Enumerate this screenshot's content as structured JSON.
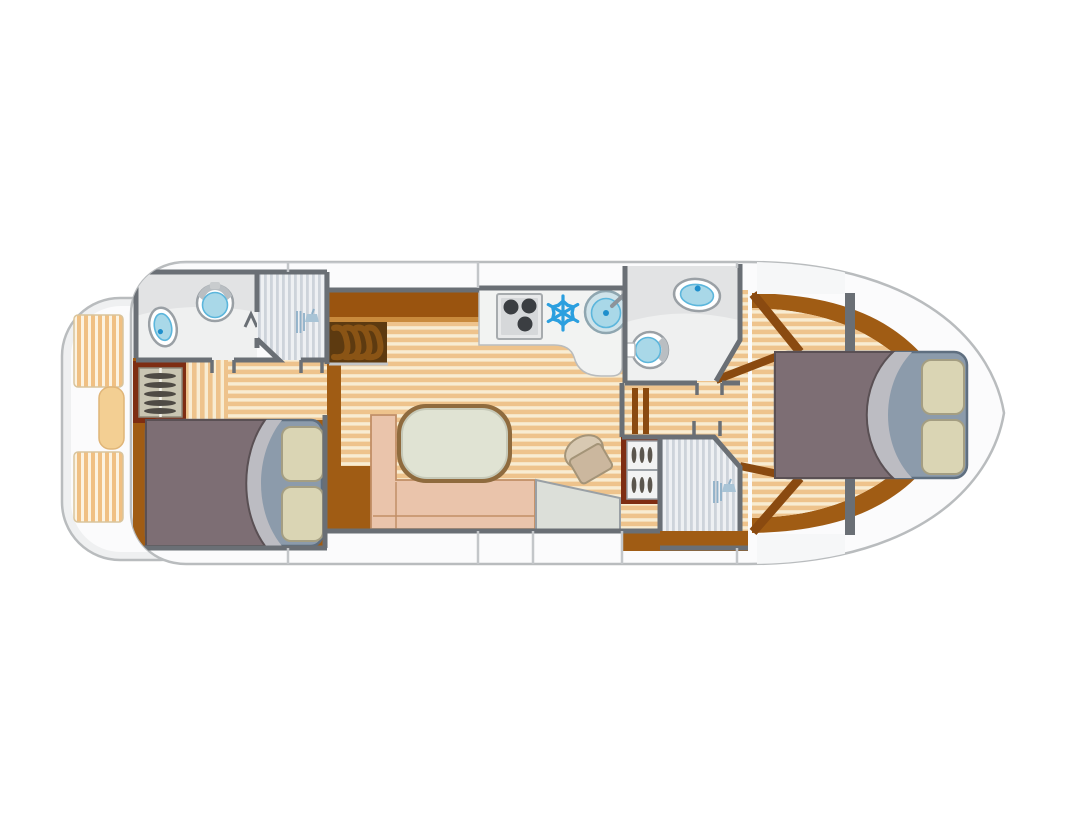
{
  "page": {
    "background": "#ffffff",
    "width": 1092,
    "height": 819
  },
  "palette": {
    "page_bg": "#ffffff",
    "hull_fill": "#fbfbfc",
    "hull_stroke": "#b9bcbe",
    "deck_fill": "#f6f7f8",
    "wall": "#6a6f75",
    "band_line": "#c3c6c9",
    "room_fill": "#eff0f0",
    "room_shade": "#e2e3e4",
    "counter_fill": "#f2f3f2",
    "wood": "#a05c14",
    "wood_dark": "#5d3a10",
    "stair_step": "#8a5415",
    "maroon_frame": "#7e2d12",
    "carpet_light": "#f8ecd2",
    "carpet_dark": "#eec38c",
    "cushion_light": "#fcf3e1",
    "cushion_dark": "#f0c083",
    "shower_light": "#eef0f3",
    "shower_dark": "#cdd3da",
    "water": "#a9d8e8",
    "water_edge": "#5cb6dc",
    "water_dot": "#1f8fcc",
    "fixture_rim": "#9aa0a5",
    "snowflake_blue": "#2b9fdf",
    "stove_body": "#d6d8da",
    "burner": "#3b3e42",
    "sofa": "#eac4ab",
    "sofa_edge": "#c18e66",
    "table_top": "#e0e3d3",
    "table_edge": "#8f6b3e",
    "helm_seat": "#d2c2ab",
    "console": "#dcdfd9",
    "duvet": "#7d6e74",
    "duvet_edge": "#5a5054",
    "turndown": "#bcbcc2",
    "mattress": "#8c9bab",
    "mattress_edge": "#5f6f80",
    "pillow": "#dad5b4",
    "pillow_edge": "#a49e82",
    "wardrobe_bg": "#c9c5b2",
    "hanger": "#4e4a44",
    "shower_icon": "#8fb0c8"
  },
  "diagram": {
    "type": "boat-floor-plan",
    "orientation": "bow-right-stern-left",
    "areas": [
      {
        "name": "aft-deck",
        "fixtures": [
          "striped-bench-cushion",
          "striped-bench-cushion",
          "seat-cushion"
        ]
      },
      {
        "name": "aft-bathroom",
        "fixtures": [
          "toilet",
          "washbasin"
        ]
      },
      {
        "name": "aft-shower",
        "fixtures": [
          "shower-head"
        ]
      },
      {
        "name": "aft-cabin",
        "fixtures": [
          "wardrobe",
          "double-bed",
          "two-pillows"
        ]
      },
      {
        "name": "salon",
        "fixtures": [
          "stairs",
          "sideboard",
          "l-shaped-sofa",
          "table",
          "helm-seat",
          "helm-console"
        ]
      },
      {
        "name": "galley",
        "fixtures": [
          "stove-3-burners",
          "fridge-snowflake",
          "round-sink-with-faucet"
        ]
      },
      {
        "name": "forward-bathroom",
        "fixtures": [
          "toilet",
          "washbasin"
        ]
      },
      {
        "name": "forward-shower",
        "fixtures": [
          "shower-head",
          "wardrobe"
        ]
      },
      {
        "name": "bow-cabin",
        "fixtures": [
          "double-bed",
          "two-pillows"
        ]
      }
    ]
  }
}
